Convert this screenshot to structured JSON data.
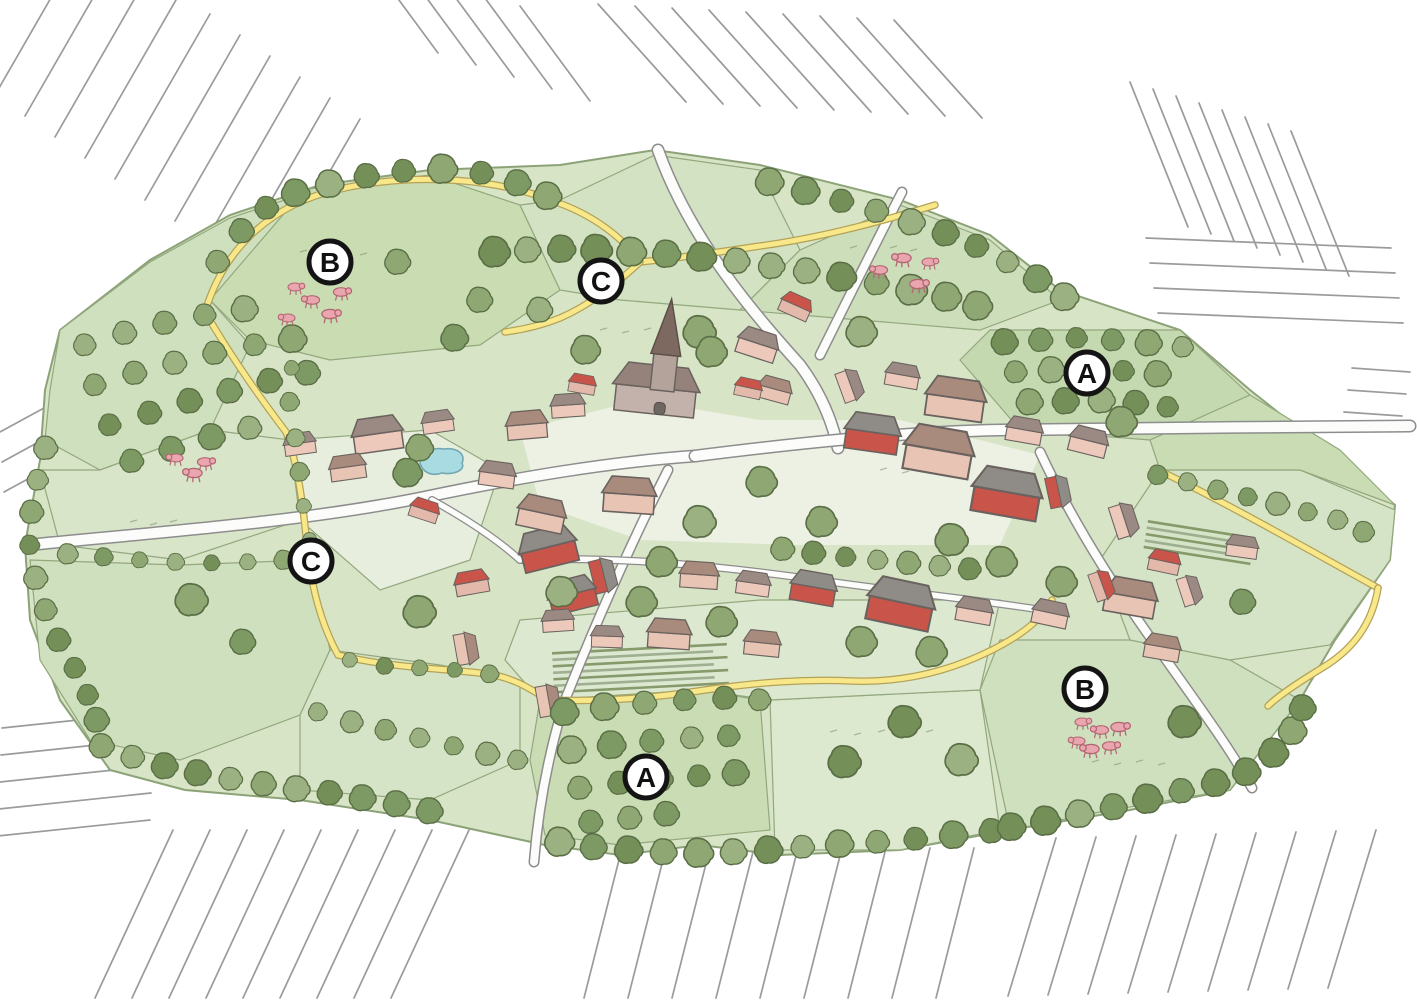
{
  "map": {
    "kind": "illustrated-village-plan",
    "markers": [
      {
        "id": "b-top",
        "label": "B",
        "transform": "translate(330,262)"
      },
      {
        "id": "c-top",
        "label": "C",
        "transform": "translate(601,281)"
      },
      {
        "id": "a-right",
        "label": "A",
        "transform": "translate(1087,373)"
      },
      {
        "id": "c-left",
        "label": "C",
        "transform": "translate(311,561)"
      },
      {
        "id": "b-bottom",
        "label": "B",
        "transform": "translate(1085,689)"
      },
      {
        "id": "a-bottom",
        "label": "A",
        "transform": "translate(646,777)"
      }
    ],
    "palette": {
      "field_green": "#cfe0bd",
      "field_light": "#e0ead2",
      "tree_green": "#8aa470",
      "tree_dark": "#74905a",
      "path_yellow": "#f8e88a",
      "road_white": "#fcfcfb",
      "road_edge": "#8d8d8d",
      "wall_pink": "#ecc9bb",
      "roof_grey": "#9b8a84",
      "roof_brown": "#a98b7d",
      "barn_red": "#c8544a",
      "pond_blue": "#a9dbe3",
      "pig_pink": "#e9a6ae",
      "hatch_grey": "#9b9b9b",
      "marker_ring": "#141414"
    },
    "features": [
      "church-icon",
      "pond",
      "pig-herd",
      "orchard",
      "hedgerow",
      "footpath",
      "road",
      "field-hatching",
      "allotment-gardens",
      "farm-buildings"
    ]
  }
}
